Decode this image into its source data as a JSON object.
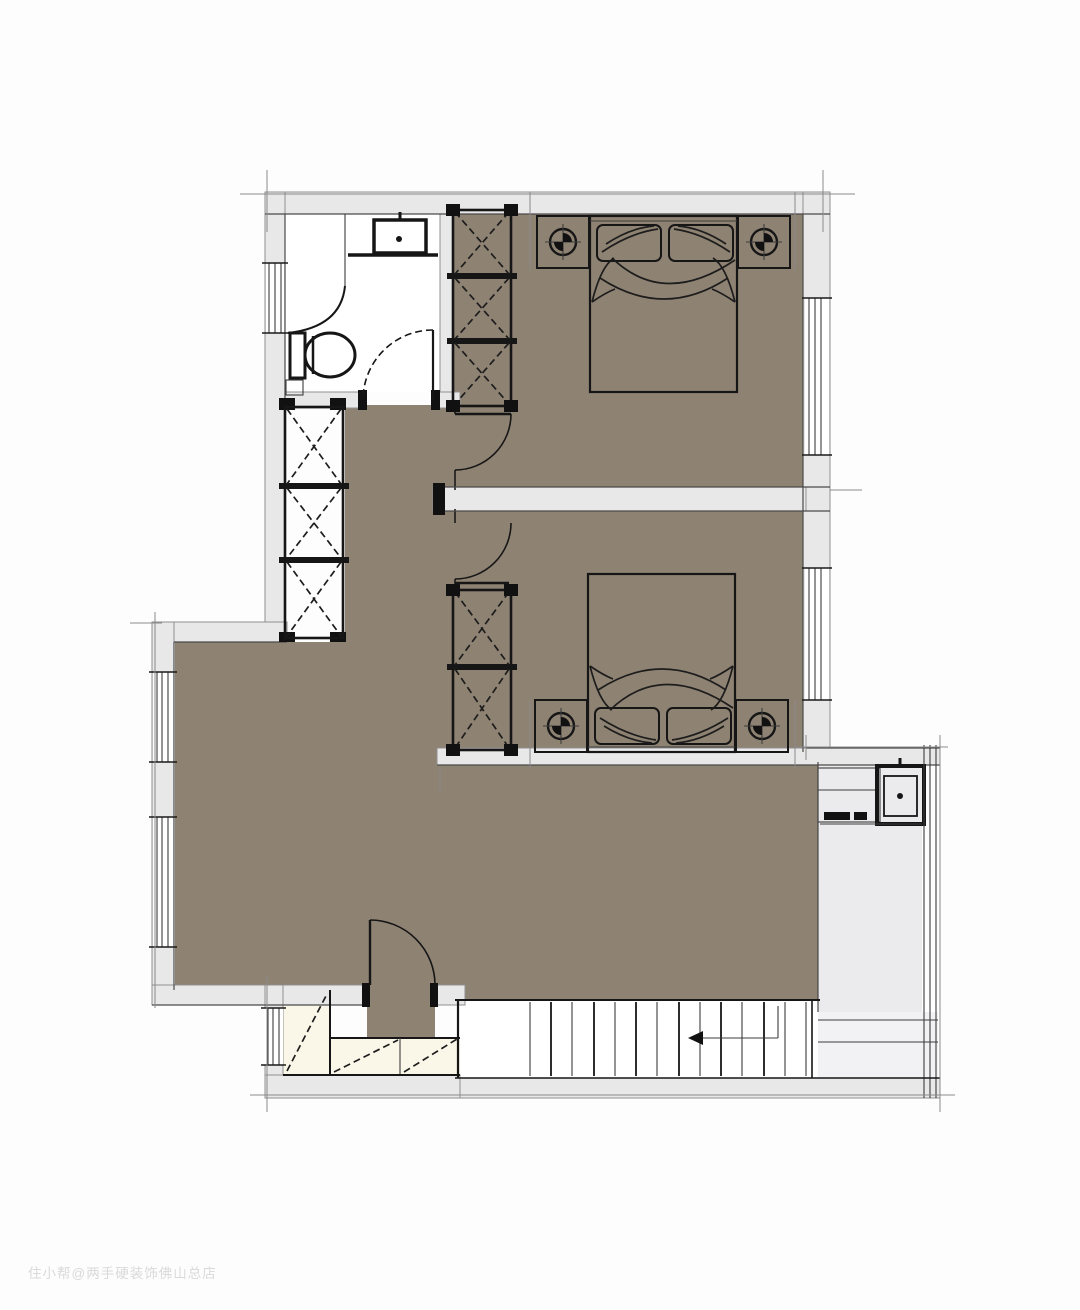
{
  "watermark": {
    "text": "住小帮@两手硬装饰佛山总店",
    "color": "#d9d9d9"
  },
  "colors": {
    "floor": "#8e8272",
    "wall_fill": "#e8e8e8",
    "bathroom_floor": "#ffffff",
    "cabinet_fill": "#faf7e8",
    "bed_fill": "#d4d4d4",
    "pillow_fill": "#dedede",
    "balcony_fill": "#ebebed",
    "stair_floor": "#ffffff",
    "landing_fill": "#f2f2f4",
    "line_dark": "#161616"
  },
  "plan": {
    "rooms": [
      {
        "id": "bathroom"
      },
      {
        "id": "bedroom-1"
      },
      {
        "id": "bedroom-2"
      },
      {
        "id": "hall-living-area"
      },
      {
        "id": "laundry-nook"
      },
      {
        "id": "balcony"
      },
      {
        "id": "stairwell"
      },
      {
        "id": "under-stair-storage"
      }
    ],
    "fixtures": {
      "double_beds": 2,
      "nightstands_with_lamps": 4,
      "wardrobe_units": 3,
      "wash_basins": 2,
      "toilets": 1,
      "doors": 4,
      "windows": 6,
      "stairs": {
        "tread_count": 14,
        "arrow_direction": "left"
      }
    }
  }
}
